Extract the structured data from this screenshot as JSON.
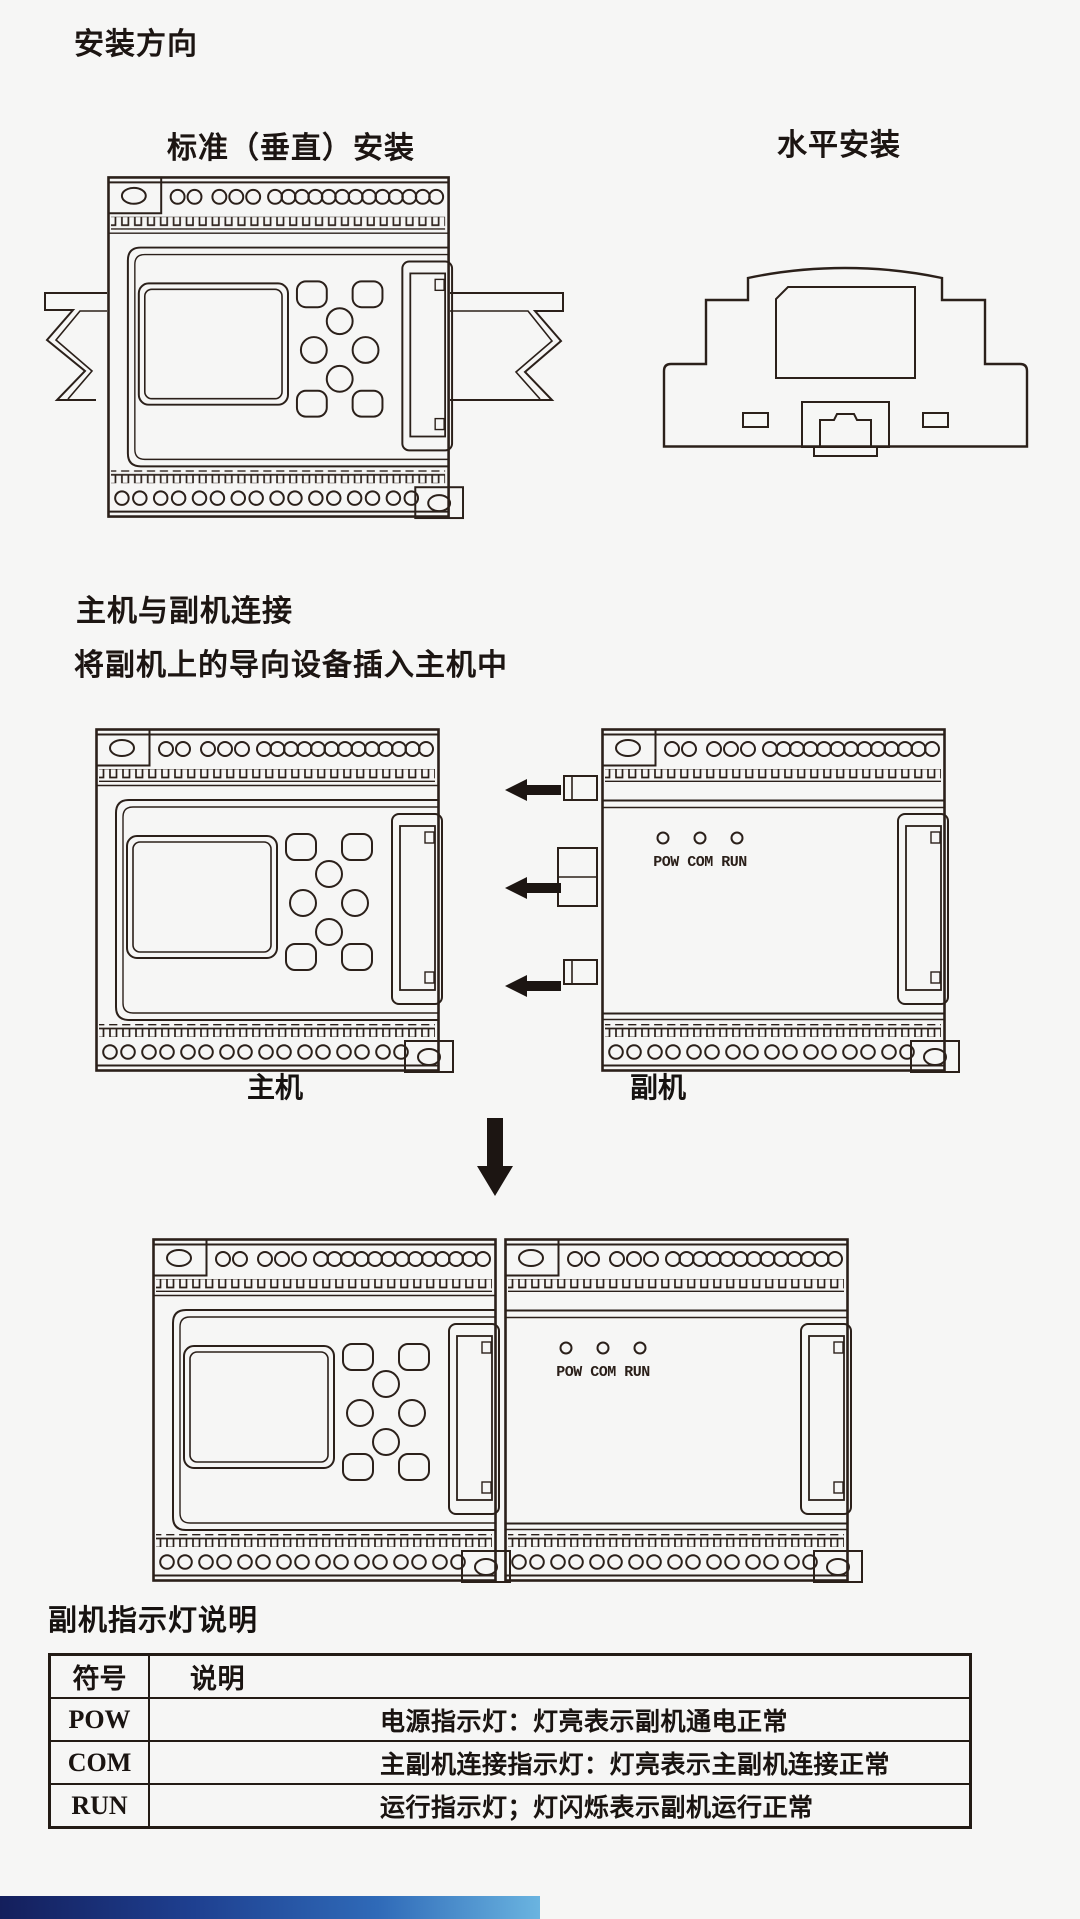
{
  "page_title": "安装方向",
  "section_mounting": {
    "label_vertical": "标准（垂直）安装",
    "label_horizontal": "水平安装"
  },
  "section_connection": {
    "heading": "主机与副机连接",
    "subheading": "将副机上的导向设备插入主机中",
    "master_label": "主机",
    "slave_label": "副机"
  },
  "device": {
    "led_labels": "POW COM RUN"
  },
  "table": {
    "title": "副机指示灯说明",
    "headers": [
      "符号",
      "说明"
    ],
    "rows": [
      {
        "symbol": "POW",
        "desc": "电源指示灯：灯亮表示副机通电正常"
      },
      {
        "symbol": "COM",
        "desc": "主副机连接指示灯：灯亮表示主副机连接正常"
      },
      {
        "symbol": "RUN",
        "desc": "运行指示灯；灯闪烁表示副机运行正常"
      }
    ]
  },
  "colors": {
    "ink": "#2b201a",
    "background": "#f6f6f5",
    "footer_gradient_start": "#141f5c",
    "footer_gradient_end": "#6ab4e0"
  }
}
